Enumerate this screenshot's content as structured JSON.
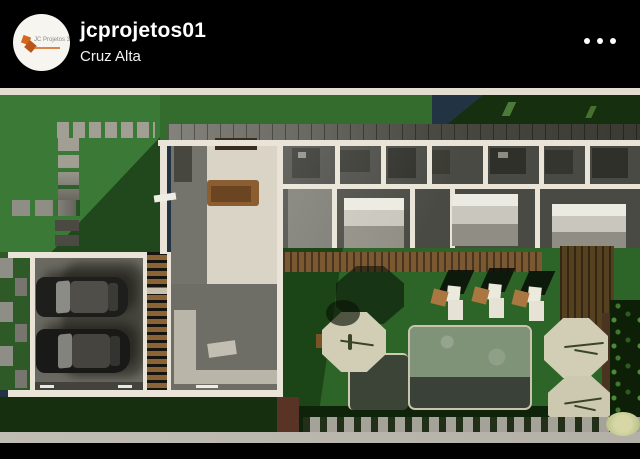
{
  "header": {
    "username": "jcprojetos01",
    "location": "Cruz Alta",
    "more_options_icon": "ellipsis-horizontal-icon",
    "avatar": {
      "logo_text": "JC Projetos 3D"
    }
  },
  "post": {
    "image_description": "3D aerial render of a residential floor plan: garage with two cars, living room, kitchen, bedroom wing, wooden decks, lawn with stepping stones, swimming pool, sun loungers and octagonal stone patios"
  },
  "palette": {
    "header-bg": "#000000",
    "text": "#ffffff",
    "photo-strip": "#e2ddd0",
    "lawn": "#3b7a36",
    "lawn-mid": "#336c2c",
    "roof-dark": "#16300f",
    "hedge": "#0e2309",
    "backyard": "#2c6527",
    "backyard-shadow": "#1c4517",
    "stone": "#a19f93",
    "stone-dark": "#5a5a50",
    "wall-cream": "#e9e4d7",
    "floor-beige": "#d9d4c5",
    "floor-gray": "#75746c",
    "floor-dark": "#4a4a45",
    "corridor": "#7b7a72",
    "counter": "#b9b6a9",
    "wood": "#7a5831",
    "wood-dark": "#55401f",
    "stair-wood": "#8a6434",
    "sofa": "#8a5e30",
    "sofa-dark": "#6b4522",
    "tv-brown": "#3a2d1f",
    "car-body": "#1e1e1c",
    "car-roof": "#504e49",
    "pool-water": "#7f9379",
    "pool-deep": "#394138",
    "spa": "#3c4438",
    "patio": "#d2ceb5",
    "tan": "#a9773f",
    "lounger-white": "#e6e3d6",
    "trunk": "#4a3420",
    "foliage": "#0d2007",
    "foliage-dot": "#3f7a2e",
    "planter-gray": "#a5a29a",
    "planter-brown": "#5a3327",
    "sidewalk": "#b3b0a7",
    "glow": "#d6d7a4",
    "pavers-green": "#2e5a27",
    "logo-orange": "#d4691e"
  }
}
